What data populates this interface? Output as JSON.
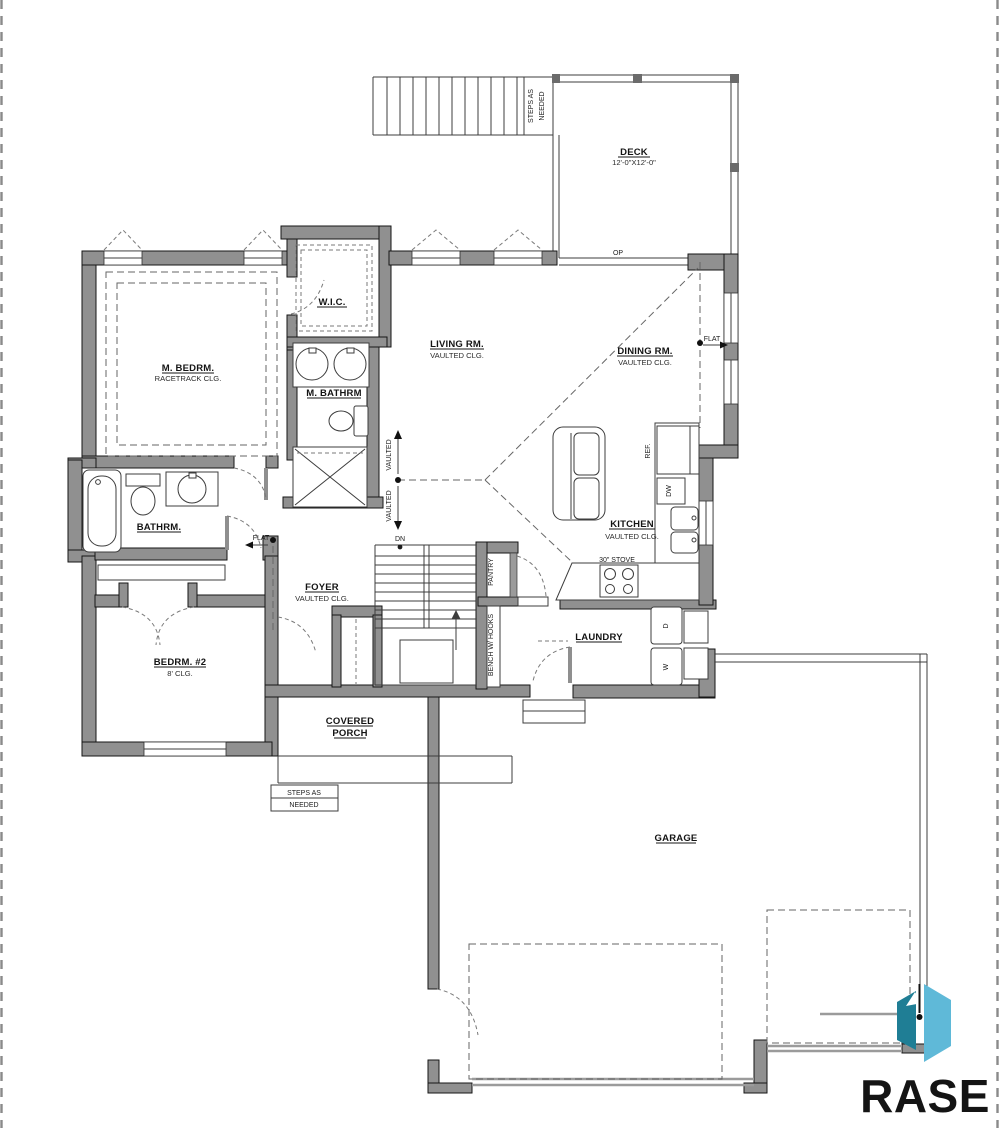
{
  "labels": {
    "deck": "DECK",
    "deck_size": "12'-0\"X12'-0\"",
    "steps1": "STEPS AS",
    "steps2": "NEEDED",
    "steps_b1": "STEPS AS",
    "steps_b2": "NEEDED",
    "op": "OP",
    "dn": "DN",
    "living": "LIVING RM.",
    "living_clg": "VAULTED CLG.",
    "dining": "DINING RM.",
    "dining_clg": "VAULTED CLG.",
    "wic": "W.I.C.",
    "mbed": "M. BEDRM.",
    "mbed_clg": "RACETRACK CLG.",
    "mbath": "M. BATHRM",
    "bath": "BATHRM.",
    "flat_l": "FLAT",
    "flat_r": "FLAT",
    "vaulted1": "VAULTED",
    "vaulted2": "VAULTED",
    "kitchen": "KITCHEN",
    "kitchen_clg": "VAULTED CLG.",
    "ref": "REF.",
    "dw": "DW",
    "stove": "30\" STOVE",
    "foyer": "FOYER",
    "foyer_clg": "VAULTED CLG.",
    "pantry": "PANTRY",
    "bench": "BENCH W/ HOOKS",
    "bed2": "BEDRM. #2",
    "bed2_clg": "8' CLG.",
    "laundry": "LAUNDRY",
    "d": "D",
    "w": "W",
    "porch1": "COVERED",
    "porch2": "PORCH",
    "garage": "GARAGE"
  },
  "colors": {
    "wall": "#909090",
    "line": "#3c3c3c",
    "dashed": "#666666",
    "garage_door": "#9b9b9b",
    "page_border": "#8a8a8a",
    "logo_dark": "#1f7e95",
    "logo_light": "#5fb9d8",
    "logo_text": "#1d3a5f"
  },
  "logo": {
    "text": "RASE"
  }
}
